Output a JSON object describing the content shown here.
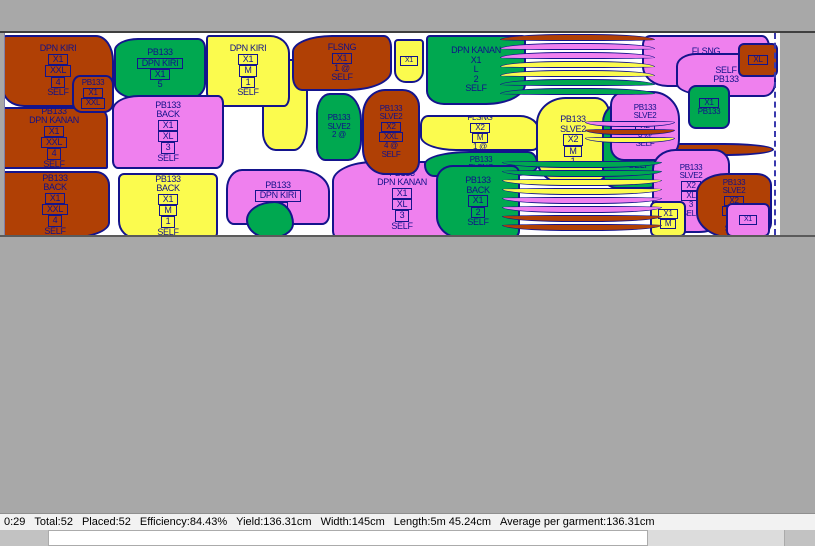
{
  "app": {
    "description": "garment marker nesting view"
  },
  "colors": {
    "background_gray": "#a8a8a8",
    "marker_white": "#ffffff",
    "outline_navy": "#14148c",
    "brown": "#b04005",
    "green": "#00a850",
    "yellow": "#fbfb4e",
    "magenta": "#ef80ee",
    "statusbar_bg": "#f2f2f2"
  },
  "marker": {
    "pieces": [
      {
        "id": "dpn-kiri-xxl",
        "c": "brown",
        "x": 2,
        "y": 2,
        "w": 112,
        "h": 72,
        "r": "4px 18px 4px 22px / 6px 26px 8px 18px",
        "lines": [
          [
            "DPN KIRI",
            0
          ],
          [
            "X1",
            1
          ],
          [
            "XXL",
            1
          ],
          [
            "4",
            1
          ],
          [
            "SELF",
            0
          ]
        ]
      },
      {
        "id": "dpn-kanan-xxl",
        "c": "brown",
        "x": 0,
        "y": 74,
        "w": 108,
        "h": 62,
        "lines": [
          [
            "PB133",
            0
          ],
          [
            "DPN KANAN",
            0
          ],
          [
            "X1",
            1
          ],
          [
            "XXL",
            1
          ],
          [
            "4",
            1
          ],
          [
            "SELF",
            0
          ]
        ],
        "r": "2px 12px 2px 2px"
      },
      {
        "id": "back-xxl",
        "c": "brown",
        "x": 0,
        "y": 138,
        "w": 110,
        "h": 68,
        "r": "2px 14px 40% 2px / 2px 14px 24% 2px",
        "lines": [
          [
            "PB133",
            0
          ],
          [
            "BACK",
            0
          ],
          [
            "X1",
            1
          ],
          [
            "XXL",
            1
          ],
          [
            "4",
            1
          ],
          [
            "SELF",
            0
          ]
        ]
      },
      {
        "id": "filler-yellow-left",
        "c": "yellow",
        "x": 262,
        "y": 26,
        "w": 46,
        "h": 92,
        "r": "10px 2px 14px 30% / 16px 4px 30% 20%",
        "lines": []
      },
      {
        "id": "flsng-x1",
        "c": "brown",
        "x": 292,
        "y": 2,
        "w": 100,
        "h": 56,
        "r": "40% 8px 45% 10px / 30% 12px 35% 14px",
        "lines": [
          [
            "FLSNG",
            0
          ],
          [
            "X1",
            1
          ],
          [
            "1 @",
            0
          ],
          [
            "SELF",
            0
          ]
        ]
      },
      {
        "id": "dpn-kiri-m",
        "c": "yellow",
        "x": 206,
        "y": 2,
        "w": 84,
        "h": 72,
        "r": "3px 20px 6px 16px / 4px 18px 10px 14px",
        "lines": [
          [
            "DPN KIRI",
            0
          ],
          [
            "X1",
            1
          ],
          [
            "M",
            1
          ],
          [
            "1",
            1
          ],
          [
            "SELF",
            0
          ]
        ]
      },
      {
        "id": "pb133-dpn-kiri",
        "c": "green",
        "x": 114,
        "y": 5,
        "w": 92,
        "h": 62,
        "r": "26% 8px 20% 30% / 20% 10px 26% 24%",
        "lines": [
          [
            "PB133",
            0
          ],
          [
            "DPN KIRI",
            1
          ],
          [
            "X1",
            1
          ],
          [
            "5",
            0
          ]
        ]
      },
      {
        "id": "dpn-kanan-l",
        "c": "green",
        "x": 426,
        "y": 2,
        "w": 100,
        "h": 70,
        "r": "4px 4px 40% 18px / 4px 4px 30% 14px",
        "lines": [
          [
            "DPN KANAN",
            0
          ],
          [
            "X1",
            0
          ],
          [
            "L",
            0
          ],
          [
            "2",
            0
          ],
          [
            "SELF",
            0
          ]
        ]
      },
      {
        "id": "flsng-xl-pink",
        "c": "magenta",
        "x": 642,
        "y": 2,
        "w": 128,
        "h": 52,
        "r": "8px 8px 30% 20% / 10px 12px 60% 40%",
        "lines": [
          [
            "FLSNG",
            0
          ],
          [
            "XL",
            0
          ],
          [
            "SELF",
            0
          ]
        ]
      },
      {
        "id": "pink-right-backdrop",
        "c": "magenta",
        "x": 676,
        "y": 20,
        "w": 100,
        "h": 44,
        "fs": 9,
        "r": "20% 8px 12px 40% / 30% 10px 14px 30%",
        "lines": [
          [
            "SELF",
            0
          ],
          [
            "PB133",
            0
          ]
        ]
      },
      {
        "id": "top-right-brown",
        "c": "brown",
        "x": 738,
        "y": 10,
        "w": 40,
        "h": 34,
        "fs": 8,
        "r": "6px",
        "lines": [
          [
            "XL",
            1
          ]
        ]
      },
      {
        "id": "notch-pb133-xxl",
        "c": "brown",
        "x": 72,
        "y": 42,
        "w": 42,
        "h": 38,
        "fs": 8,
        "r": "8px 8px 10px 10px / 10px",
        "lines": [
          [
            "PB133",
            0
          ],
          [
            "X1",
            1
          ],
          [
            "XXL",
            1
          ]
        ]
      },
      {
        "id": "back-xl-pink",
        "c": "magenta",
        "x": 112,
        "y": 62,
        "w": 112,
        "h": 74,
        "r": "24% 6px 8px 6px / 20% 8px 10px 8px",
        "lines": [
          [
            "PB133",
            0
          ],
          [
            "BACK",
            0
          ],
          [
            "X1",
            1
          ],
          [
            "XL",
            1
          ],
          [
            "3",
            1
          ],
          [
            "SELF",
            0
          ]
        ]
      },
      {
        "id": "back-m-yellow",
        "c": "yellow",
        "x": 118,
        "y": 140,
        "w": 100,
        "h": 66,
        "r": "6px 6px 6px 18px",
        "lines": [
          [
            "PB133",
            0
          ],
          [
            "BACK",
            0
          ],
          [
            "X1",
            1
          ],
          [
            "M",
            1
          ],
          [
            "1",
            1
          ],
          [
            "SELF",
            0
          ]
        ]
      },
      {
        "id": "dpn-kiri-pink",
        "c": "magenta",
        "x": 226,
        "y": 136,
        "w": 104,
        "h": 56,
        "r": "16px 30% 8px 8px / 20px 40% 10px 10px",
        "lines": [
          [
            "PB133",
            0
          ],
          [
            "DPN KIRI",
            1
          ],
          [
            "X1",
            1
          ]
        ]
      },
      {
        "id": "dpn-kanan-xl-pink",
        "c": "magenta",
        "x": 332,
        "y": 128,
        "w": 140,
        "h": 78,
        "r": "30% 6px 6px 6px / 26% 8px 8px 8px",
        "lines": [
          [
            "PB133",
            0
          ],
          [
            "DPN KANAN",
            0
          ],
          [
            "X1",
            1
          ],
          [
            "XL",
            1
          ],
          [
            "3",
            1
          ],
          [
            "SELF",
            0
          ]
        ]
      },
      {
        "id": "slve2-xxl-brown",
        "c": "brown",
        "x": 362,
        "y": 56,
        "w": 58,
        "h": 86,
        "fs": 8,
        "r": "40% 30% 20% 40% / 30% 20% 16% 30%",
        "lines": [
          [
            "PB133",
            0
          ],
          [
            "SLVE2",
            0
          ],
          [
            "X2",
            1
          ],
          [
            "XXL",
            1
          ],
          [
            "4 @",
            0
          ],
          [
            "SELF",
            0
          ]
        ]
      },
      {
        "id": "slve2-green-left",
        "c": "green",
        "x": 316,
        "y": 60,
        "w": 46,
        "h": 68,
        "fs": 8,
        "r": "30% 40% 30% 20%",
        "lines": [
          [
            "PB133",
            0
          ],
          [
            "SLVE2",
            0
          ],
          [
            "2 @",
            0
          ]
        ]
      },
      {
        "id": "flsng-strip-yellow",
        "c": "yellow",
        "x": 420,
        "y": 82,
        "w": 120,
        "h": 36,
        "fs": 8,
        "r": "8px 20px 8px 30% / 10px 16px 8px 40%",
        "lines": [
          [
            "FLSNG",
            0
          ],
          [
            "X2",
            1
          ],
          [
            "M",
            1
          ],
          [
            "1 @",
            0
          ]
        ]
      },
      {
        "id": "flsng-strip-green",
        "c": "green",
        "x": 424,
        "y": 118,
        "w": 114,
        "h": 26,
        "fs": 8,
        "r": "40% 10px 30% 10px / 50% 12px 40% 12px",
        "lines": [
          [
            "PB133",
            0
          ],
          [
            "FLSNG",
            0
          ]
        ]
      },
      {
        "id": "back-l-green",
        "c": "green",
        "x": 436,
        "y": 132,
        "w": 84,
        "h": 74,
        "r": "20% 8px 8px 30%",
        "lines": [
          [
            "PB133",
            0
          ],
          [
            "BACK",
            0
          ],
          [
            "X1",
            1
          ],
          [
            "2",
            1
          ],
          [
            "SELF",
            0
          ]
        ]
      },
      {
        "id": "waistband-brown",
        "c": "brown",
        "x": 574,
        "y": 110,
        "w": 200,
        "h": 13,
        "r": "50% / 100%",
        "lines": []
      },
      {
        "id": "slve2-m-yellow",
        "c": "yellow",
        "x": 536,
        "y": 64,
        "w": 74,
        "h": 88,
        "r": "40% 20% 30% 40% / 30% 18% 22% 30%",
        "lines": [
          [
            "PB133",
            0
          ],
          [
            "SLVE2",
            0
          ],
          [
            "X2",
            1
          ],
          [
            "M",
            1
          ],
          [
            "1",
            0
          ]
        ]
      },
      {
        "id": "slve2-l-green",
        "c": "green",
        "x": 602,
        "y": 68,
        "w": 74,
        "h": 88,
        "r": "30% 40% 40% 20% / 24% 30% 30% 18%",
        "lines": [
          [
            "PB133",
            0
          ],
          [
            "SLVE2",
            0
          ],
          [
            "X2",
            1
          ],
          [
            "2",
            1
          ],
          [
            "SELF",
            0
          ]
        ]
      },
      {
        "id": "slve2-pink-a",
        "c": "magenta",
        "x": 610,
        "y": 58,
        "w": 70,
        "h": 70,
        "fs": 8,
        "r": "20% 40% 30% 20%",
        "lines": [
          [
            "PB133",
            0
          ],
          [
            "SLVE2",
            0
          ],
          [
            "X2",
            1
          ],
          [
            "3 @",
            0
          ],
          [
            "SELF",
            0
          ]
        ]
      },
      {
        "id": "slve2-pink-b",
        "c": "magenta",
        "x": 652,
        "y": 116,
        "w": 78,
        "h": 84,
        "fs": 8,
        "r": "30% 20% 40% 30% / 24% 18% 30% 26%",
        "lines": [
          [
            "PB133",
            0
          ],
          [
            "SLVE2",
            0
          ],
          [
            "X2",
            1
          ],
          [
            "XL",
            1
          ],
          [
            "3",
            0
          ],
          [
            "SELF",
            0
          ]
        ]
      },
      {
        "id": "slve2-brown-c",
        "c": "brown",
        "x": 696,
        "y": 140,
        "w": 76,
        "h": 66,
        "fs": 8,
        "r": "40% 20% 30% 50% / 30% 18% 24% 40%",
        "lines": [
          [
            "PB133",
            0
          ],
          [
            "SLVE2",
            0
          ],
          [
            "X2",
            1
          ],
          [
            "XXL",
            1
          ],
          [
            "4",
            0
          ],
          [
            "SELF",
            0
          ]
        ]
      },
      {
        "id": "green-x1",
        "c": "green",
        "x": 688,
        "y": 52,
        "w": 42,
        "h": 44,
        "fs": 8,
        "r": "8px",
        "lines": [
          [
            "X1",
            1
          ],
          [
            "PB133",
            0
          ]
        ]
      },
      {
        "id": "yellow-x1-m",
        "c": "yellow",
        "x": 650,
        "y": 168,
        "w": 36,
        "h": 36,
        "fs": 8,
        "r": "6px",
        "lines": [
          [
            "X1",
            1
          ],
          [
            "M",
            1
          ]
        ]
      },
      {
        "id": "pink-small-br",
        "c": "magenta",
        "x": 726,
        "y": 170,
        "w": 44,
        "h": 34,
        "fs": 7,
        "r": "6px",
        "lines": [
          [
            "X1",
            1
          ]
        ]
      },
      {
        "id": "tiny-yellow-top",
        "c": "yellow",
        "x": 394,
        "y": 6,
        "w": 30,
        "h": 44,
        "fs": 7,
        "r": "4px 4px 12px 12px",
        "lines": [
          [
            "X1",
            1
          ]
        ]
      },
      {
        "id": "green-blob",
        "c": "green",
        "x": 246,
        "y": 168,
        "w": 48,
        "h": 38,
        "r": "60% 40% 50% 50% / 50% 60% 40% 50%",
        "lines": []
      }
    ],
    "stacks": [
      {
        "id": "arc-stack-top",
        "x": 500,
        "y": 1,
        "w": 155,
        "h": 64,
        "gap": 9,
        "bh": 7,
        "dir": "arch",
        "band_colors": [
          "brown",
          "magenta",
          "magenta",
          "yellow",
          "yellow",
          "green",
          "green"
        ]
      },
      {
        "id": "arc-stack-bottom",
        "x": 502,
        "y": 128,
        "w": 160,
        "h": 78,
        "gap": 9,
        "bh": 7,
        "dir": "bowl",
        "band_colors": [
          "green",
          "green",
          "yellow",
          "yellow",
          "magenta",
          "magenta",
          "brown",
          "brown"
        ]
      },
      {
        "id": "arc-stack-right",
        "x": 585,
        "y": 88,
        "w": 90,
        "h": 26,
        "gap": 8,
        "bh": 6,
        "dir": "bowl",
        "band_colors": [
          "magenta",
          "brown",
          "yellow"
        ]
      }
    ]
  },
  "status": {
    "items": [
      "0:29",
      "Total:52",
      "Placed:52",
      "Efficiency:84.43%",
      "Yield:136.31cm",
      "Width:145cm",
      "Length:5m 45.24cm",
      "Average per garment:136.31cm"
    ]
  }
}
